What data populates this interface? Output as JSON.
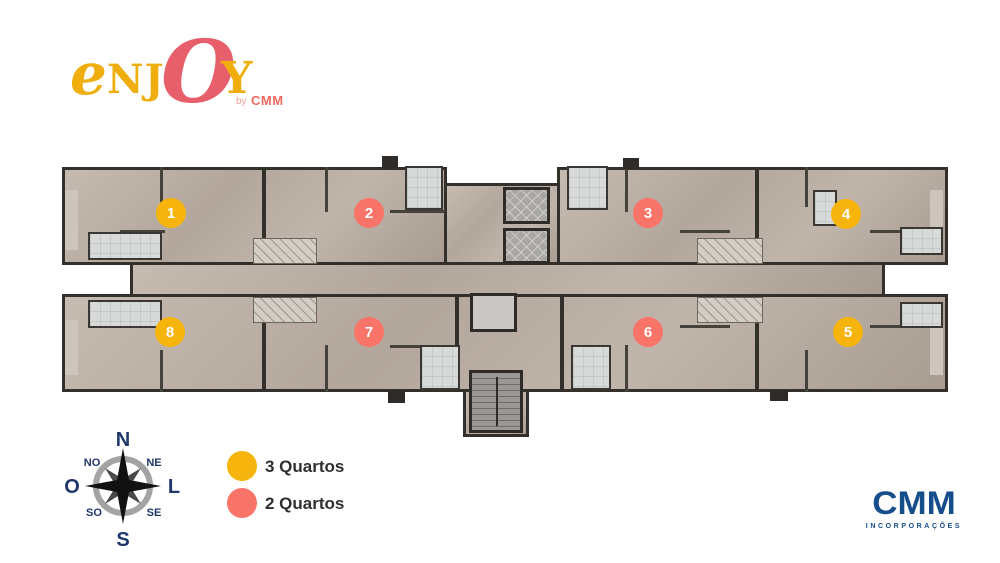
{
  "brand": {
    "logo": {
      "e": "e",
      "nj": "NJ",
      "o": "O",
      "y": "Y",
      "by": "by",
      "by_brand": "CMM"
    }
  },
  "plan": {
    "units": [
      {
        "number": "1",
        "type": "3 Quartos",
        "color": "#F6B40D"
      },
      {
        "number": "2",
        "type": "2 Quartos",
        "color": "#F97468"
      },
      {
        "number": "3",
        "type": "2 Quartos",
        "color": "#F97468"
      },
      {
        "number": "4",
        "type": "3 Quartos",
        "color": "#F6B40D"
      },
      {
        "number": "5",
        "type": "3 Quartos",
        "color": "#F6B40D"
      },
      {
        "number": "6",
        "type": "2 Quartos",
        "color": "#F97468"
      },
      {
        "number": "7",
        "type": "2 Quartos",
        "color": "#F97468"
      },
      {
        "number": "8",
        "type": "3 Quartos",
        "color": "#F6B40D"
      }
    ]
  },
  "legend": {
    "items": [
      {
        "label": "3 Quartos",
        "color": "#F6B40D"
      },
      {
        "label": "2 Quartos",
        "color": "#F97468"
      }
    ]
  },
  "compass": {
    "n": "N",
    "ne": "NE",
    "e": "L",
    "se": "SE",
    "s": "S",
    "sw": "SO",
    "w": "O",
    "nw": "NO"
  },
  "footer": {
    "brand": "CMM",
    "subtitle": "INCORPORAÇÕES"
  },
  "colors": {
    "yellow": "#F6B40D",
    "coral": "#F97468",
    "compass_navy": "#20376B",
    "cmm_blue": "#164E8C",
    "logo_gold": "#EFAE0E",
    "logo_coral": "#E75F6B",
    "wall_dark": "#33302C",
    "floor_beige": "#B6AAA0"
  }
}
